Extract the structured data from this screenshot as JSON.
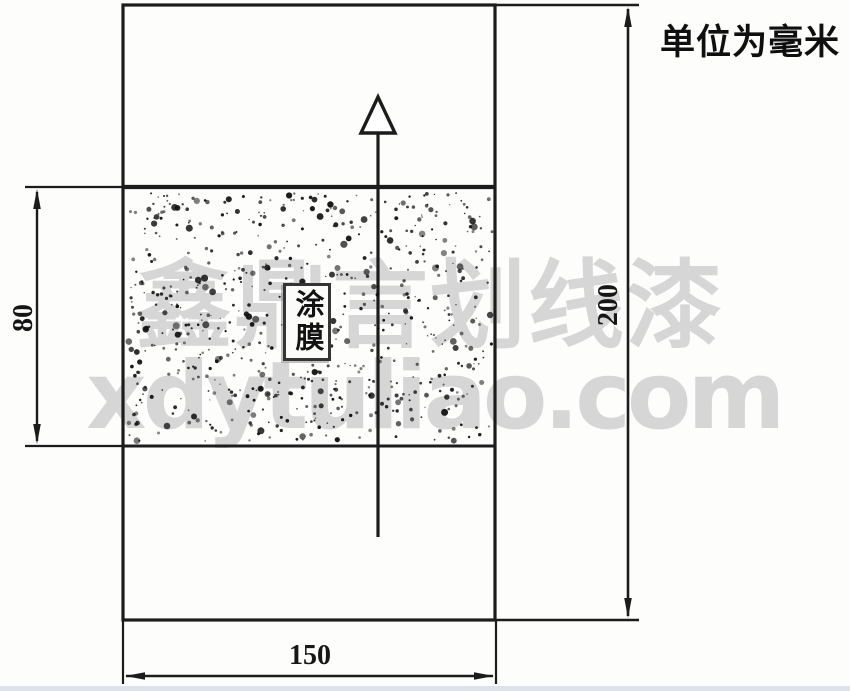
{
  "unit_note": "单位为毫米",
  "specimen": {
    "coating_label": "涂膜",
    "dimensions": {
      "band_height_mm": "80",
      "panel_height_mm": "200",
      "panel_width_mm": "150"
    }
  },
  "watermark": {
    "line1": "鑫鼎言划线漆",
    "line2": "xdytuliao.com"
  },
  "colors": {
    "line": "#1c1c1c",
    "watermark_gray": "#969698",
    "background": "#fdfdfc",
    "bottom_strip": "#dde3ec"
  }
}
